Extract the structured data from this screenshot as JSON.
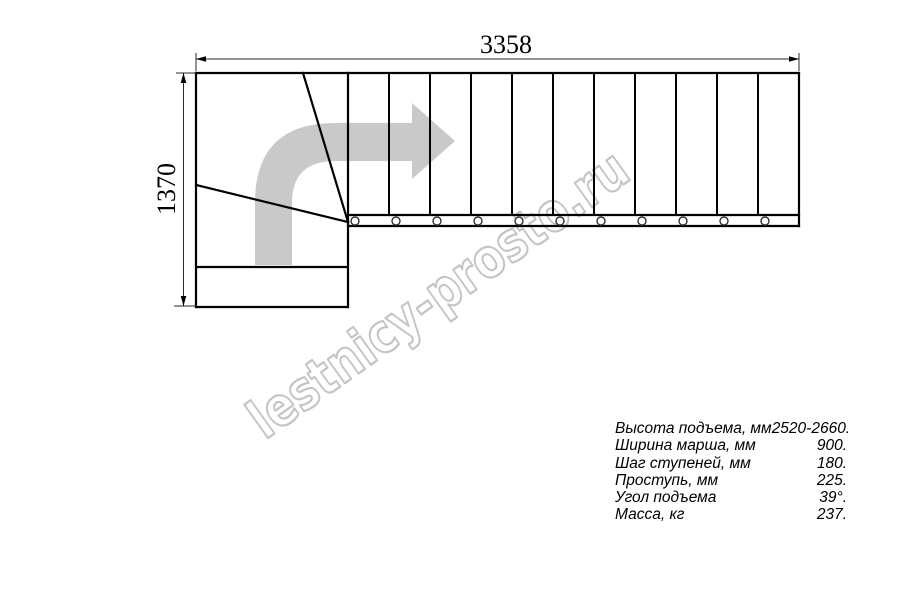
{
  "drawing": {
    "type": "staircase-plan-top-view",
    "dimensions": {
      "width_label": "3358",
      "height_label": "1370"
    },
    "plan": {
      "straight_treads": 10,
      "winder_treads": 3,
      "bolt_count": 11,
      "direction": "up-then-right",
      "line_color": "#000000",
      "arrow_color": "#c9c9c9"
    }
  },
  "watermark": {
    "text": "lestnicy-prosto.ru",
    "color": "#c4c4c4"
  },
  "specs": {
    "rows": [
      {
        "label": "Высота подъема, мм",
        "value": "2520-2660."
      },
      {
        "label": "Ширина марша, мм",
        "value": "900."
      },
      {
        "label": "Шаг ступеней, мм",
        "value": "180."
      },
      {
        "label": "Проступь, мм",
        "value": "225."
      },
      {
        "label": "Угол подъема",
        "value": "39°."
      },
      {
        "label": "Масса, кг",
        "value": "237."
      }
    ]
  }
}
